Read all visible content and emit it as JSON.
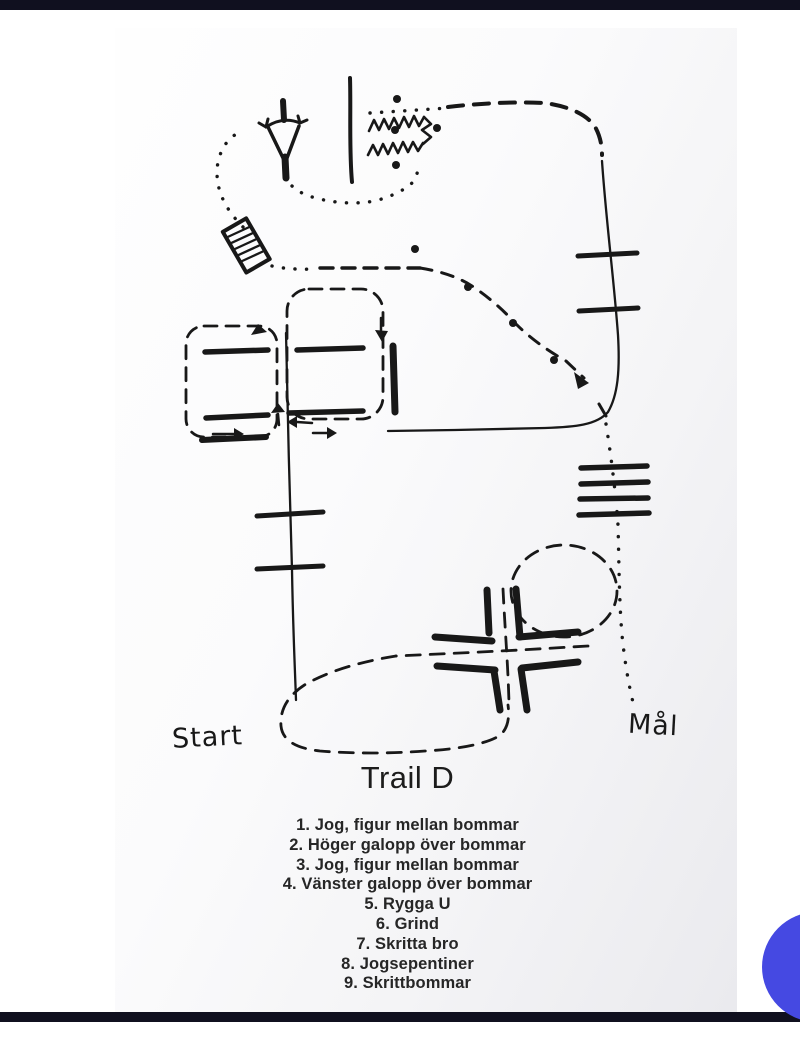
{
  "colors": {
    "ink": "#181818",
    "edge_bar": "#10101f",
    "fab_blue": "#4549e2",
    "paper_light": "#fefefe",
    "paper_shade": "#eaeaee",
    "page_background": "#ffffff"
  },
  "course_map": {
    "title": "Trail D",
    "start_label": "Start",
    "goal_label": "Mål"
  },
  "course_list": {
    "items": [
      "1. Jog, figur mellan bommar",
      "2. Höger galopp över bommar",
      "3. Jog, figur mellan bommar",
      "4. Vänster galopp över bommar",
      "5. Rygga U",
      "6. Grind",
      "7. Skritta bro",
      "8. Jogsepentiner",
      "9. Skrittbommar"
    ]
  }
}
